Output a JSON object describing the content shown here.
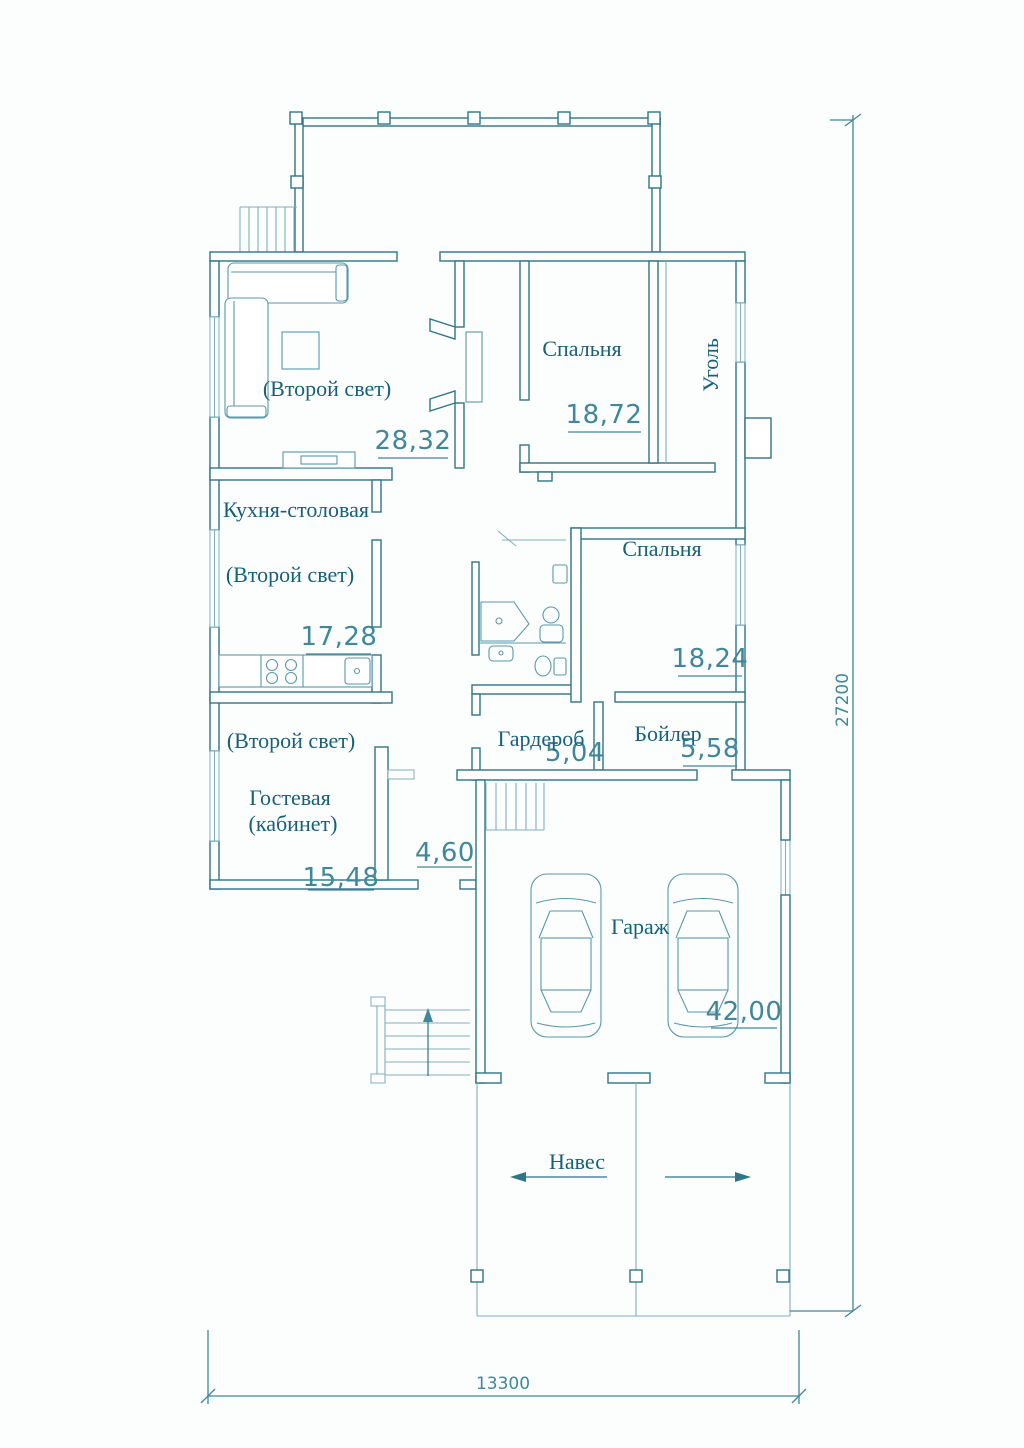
{
  "colors": {
    "wall_line": "#2e7585",
    "label_text": "#17607a",
    "dimension": "#3f8799",
    "light_line": "#7fb0bc",
    "background": "#fcfdfd"
  },
  "rooms": {
    "living": {
      "second_light": "(Второй свет)",
      "area": "28,32"
    },
    "bedroom_top": {
      "label": "Спальня",
      "area": "18,72"
    },
    "coal": {
      "label": "Уголь"
    },
    "kitchen": {
      "label": "Кухня-столовая",
      "second_light": "(Второй свет)",
      "area": "17,28"
    },
    "bedroom_mid": {
      "label": "Спальня",
      "area": "18,24"
    },
    "wardrobe": {
      "label": "Гардероб",
      "area": "5,04"
    },
    "boiler": {
      "label": "Бойлер",
      "area": "5,58"
    },
    "guest": {
      "second_light": "(Второй свет)",
      "name_line1": "Гостевая",
      "name_line2": "(кабинет)",
      "area": "15,48"
    },
    "entry_hall": {
      "area": "4,60"
    },
    "garage": {
      "label": "Гараж",
      "area": "42,00"
    },
    "canopy": {
      "label": "Навес"
    }
  },
  "overall_dimensions": {
    "vertical": "27200",
    "horizontal": "13300"
  }
}
